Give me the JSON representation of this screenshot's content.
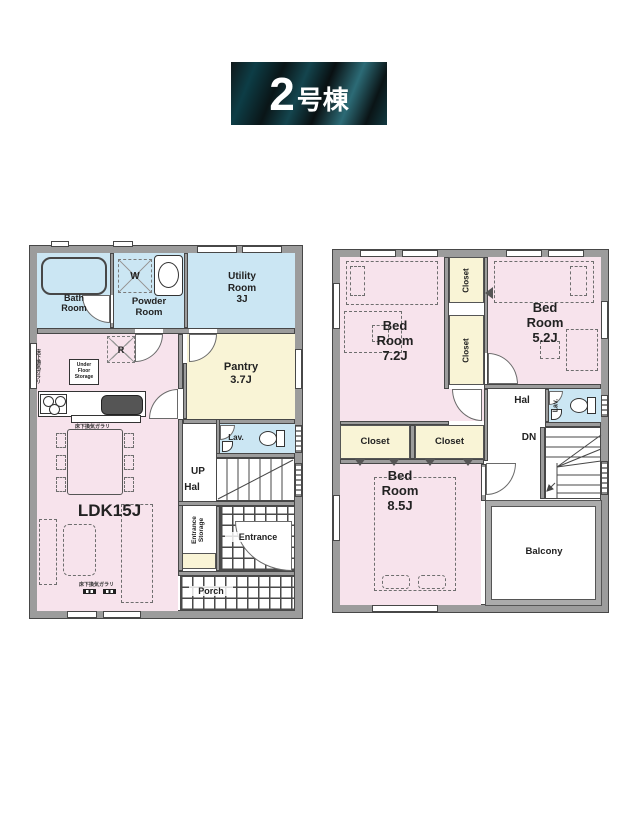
{
  "title": {
    "number": "2",
    "suffix": "号棟"
  },
  "colors": {
    "room_pink": "#f7e3ec",
    "room_blue": "#cbe6f3",
    "room_cream": "#f9f4d6",
    "wall_gray": "#9c9c9c",
    "badge_dark": "#0a1416",
    "badge_teal": "#2c6b76"
  },
  "floor1": {
    "rooms": {
      "bath": "Bath\nRoom",
      "powder": "Powder\nRoom",
      "utility": "Utility\nRoom\n3J",
      "pantry": "Pantry\n3.7J",
      "ldk": "LDK15J",
      "lav": "Lav.",
      "up": "UP",
      "hal": "Hal",
      "entrance": "Entrance",
      "entrance_storage": "Entrance\nStorage",
      "porch": "Porch"
    },
    "fixtures": {
      "fridge": "R",
      "washer": "W",
      "under_floor_storage": "Under\nFloor\nStorage",
      "vent_note": "床下換気ガラリ"
    }
  },
  "floor2": {
    "rooms": {
      "bed_room_1": "Bed\nRoom\n7.2J",
      "bed_room_2": "Bed\nRoom\n5.2J",
      "bed_room_3": "Bed\nRoom\n8.5J",
      "closet_v1": "Closet",
      "closet_v2": "Closet",
      "closet_a": "Closet",
      "closet_b": "Closet",
      "hal": "Hal",
      "dn": "DN",
      "lav": "Lav.",
      "balcony": "Balcony"
    }
  }
}
